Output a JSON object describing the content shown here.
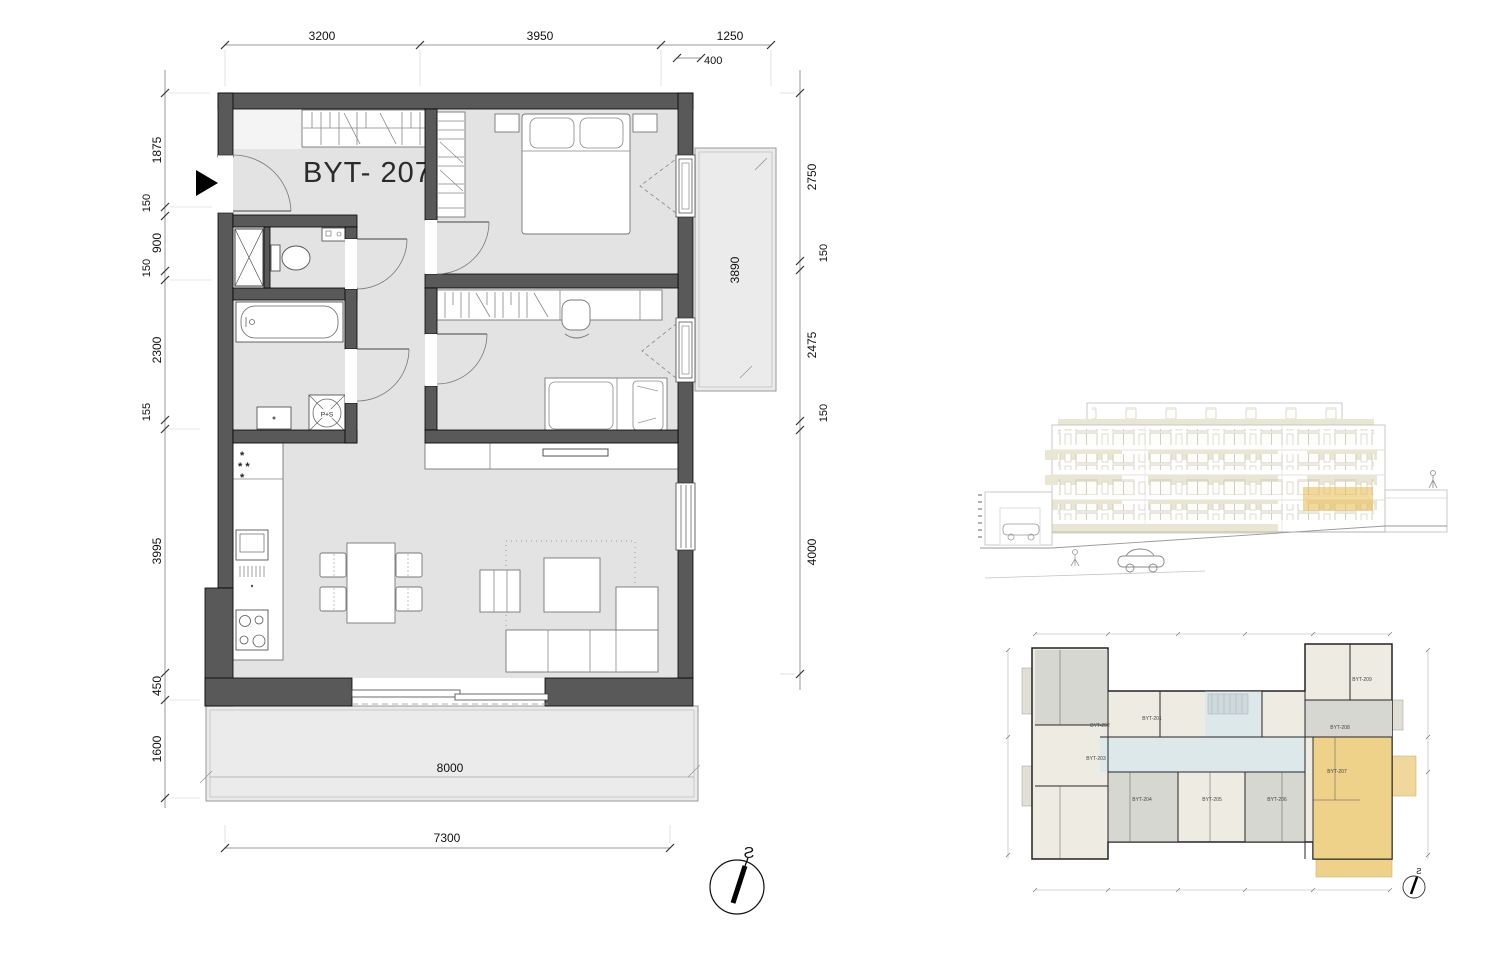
{
  "plan": {
    "apartment_label": "BYT- 207",
    "washer_label": "P+S",
    "freezer_row1": "*",
    "freezer_row2": "* *",
    "freezer_row3": "*",
    "compass_label": "S",
    "dims": {
      "top_1": "3200",
      "top_2": "3950",
      "top_3": "1250",
      "top_sub": "400",
      "left_1": "1875",
      "left_2": "150",
      "left_3": "900",
      "left_4": "150",
      "left_5": "2300",
      "left_6": "155",
      "left_7": "3995",
      "left_8": "450",
      "left_9": "1600",
      "right_1": "2750",
      "right_2": "150",
      "right_3": "2475",
      "right_4": "150",
      "right_5": "4000",
      "balcony_side": "3890",
      "terrace": "8000",
      "bottom": "7300"
    }
  },
  "overview": {
    "compass_label": "S",
    "labels": {
      "a201": "BYT-201",
      "a202": "BYT-202",
      "a203": "BYT-203",
      "a204": "BYT-204",
      "a205": "BYT-205",
      "a206": "BYT-206",
      "a207": "BYT-207",
      "a208": "BYT-208",
      "a209": "BYT-209"
    }
  },
  "colors": {
    "wall": "#595959",
    "floor": "#e3e3e3",
    "balcony": "#ebebeb",
    "highlight": "#eed289",
    "corridor": "#dce8ea",
    "beige_band": "#eae6d4",
    "apt_gray": "#d7d7d2",
    "apt_cream": "#eeece2"
  }
}
